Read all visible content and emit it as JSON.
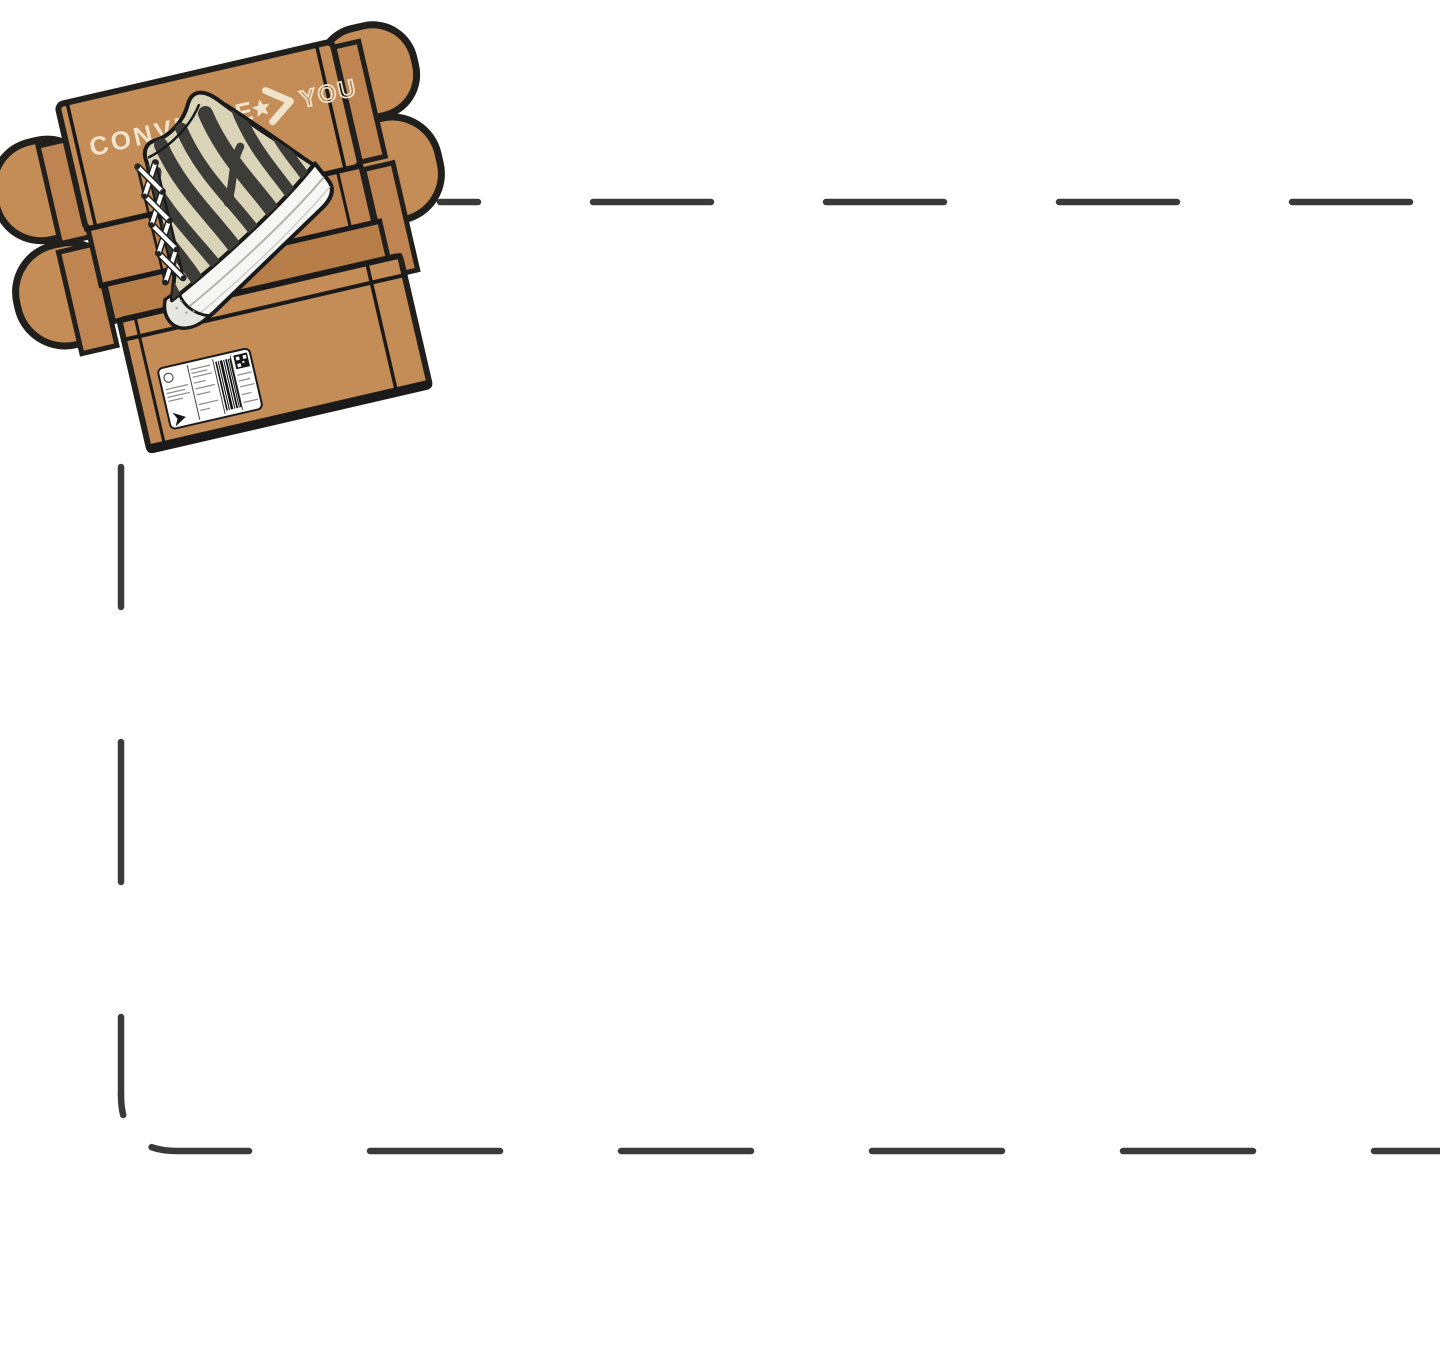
{
  "box": {
    "brand": "CONVERSE",
    "brand_secondary": "YOU"
  },
  "colors": {
    "background": "#ffffff",
    "dash": "#3a3a3a",
    "outline": "#1a1a1a",
    "cardboard": "#c78e58",
    "cardboard-mid": "#c18552",
    "cardboard-dark": "#b97e49",
    "cream": "#f0e4cc",
    "canvas": "#d9d4b8",
    "stripe": "#3c3c38",
    "sole": "#f6f6f4",
    "label": "#ffffff"
  }
}
